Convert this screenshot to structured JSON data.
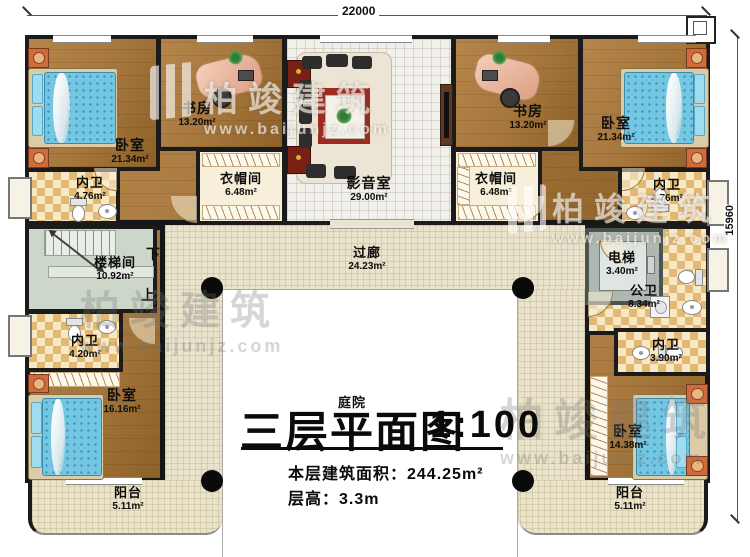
{
  "title": {
    "main": "三层平面图",
    "scale": "1:100",
    "area_line": "本层建筑面积：244.25m²",
    "height_line": "层高：3.3m"
  },
  "dimensions": {
    "width": "22000",
    "height": "15960"
  },
  "stairs": {
    "down": "下",
    "up": "上"
  },
  "watermark": {
    "brand": "柏竣建筑",
    "url": "www.baijunjz.com"
  },
  "rooms": {
    "bedroom_tl": {
      "name": "卧室",
      "area": "21.34m²"
    },
    "study_left": {
      "name": "书房",
      "area": "13.20m²"
    },
    "media_room": {
      "name": "影音室",
      "area": "29.00m²"
    },
    "study_right": {
      "name": "书房",
      "area": "13.20m²"
    },
    "bedroom_tr": {
      "name": "卧室",
      "area": "21.34m²"
    },
    "bath_tl": {
      "name": "内卫",
      "area": "4.76m²"
    },
    "closet_left": {
      "name": "衣帽间",
      "area": "6.48m²"
    },
    "closet_right": {
      "name": "衣帽间",
      "area": "6.48m²"
    },
    "bath_tr": {
      "name": "内卫",
      "area": "4.76m²"
    },
    "stairwell": {
      "name": "楼梯间",
      "area": "10.92m²"
    },
    "corridor": {
      "name": "过廊",
      "area": "24.23m²"
    },
    "elevator": {
      "name": "电梯",
      "area": "3.40m²"
    },
    "public_bath": {
      "name": "公卫",
      "area": "8.34m²"
    },
    "bath_bl": {
      "name": "内卫",
      "area": "4.20m²"
    },
    "bath_br": {
      "name": "内卫",
      "area": "3.90m²"
    },
    "bedroom_bl": {
      "name": "卧室",
      "area": "16.16m²"
    },
    "bedroom_br": {
      "name": "卧室",
      "area": "14.38m²"
    },
    "balcony_left": {
      "name": "阳台",
      "area": "5.11m²"
    },
    "balcony_right": {
      "name": "阳台",
      "area": "5.11m²"
    },
    "courtyard": {
      "name": "庭院"
    }
  },
  "colors": {
    "wall": "#1b1b1b",
    "wood": "#a5763c",
    "bath_tile": "#e3b872",
    "bed": "#74c7e3",
    "rug": "#9e2b20"
  }
}
